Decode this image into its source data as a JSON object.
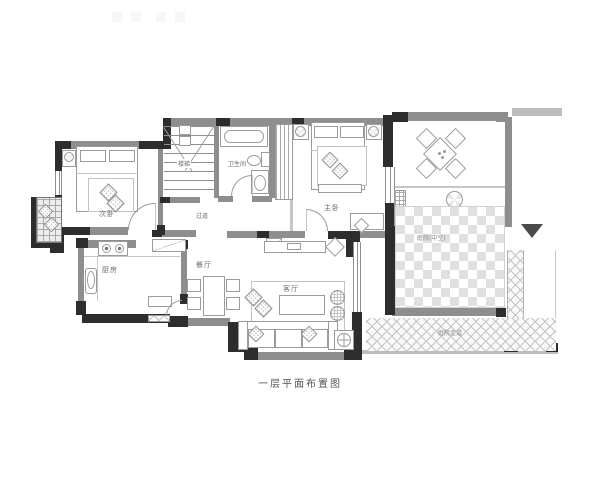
{
  "caption": "一层平面布置图",
  "rooms": {
    "secondary_bedroom": "次卧",
    "stairs": "楼梯",
    "bathroom": "卫生间",
    "master_bedroom": "主卧",
    "corridor": "过道",
    "kitchen": "厨房",
    "dining_room": "餐厅",
    "living_room": "客厅",
    "atrium": "庭院(中空)",
    "garden_path": "庭院走道"
  },
  "colors": {
    "wall_dark": "#2d2d2d",
    "wall_gray": "#8e8e8e",
    "furniture_line": "#9b9b9b",
    "label_text": "#6a6a6a"
  }
}
